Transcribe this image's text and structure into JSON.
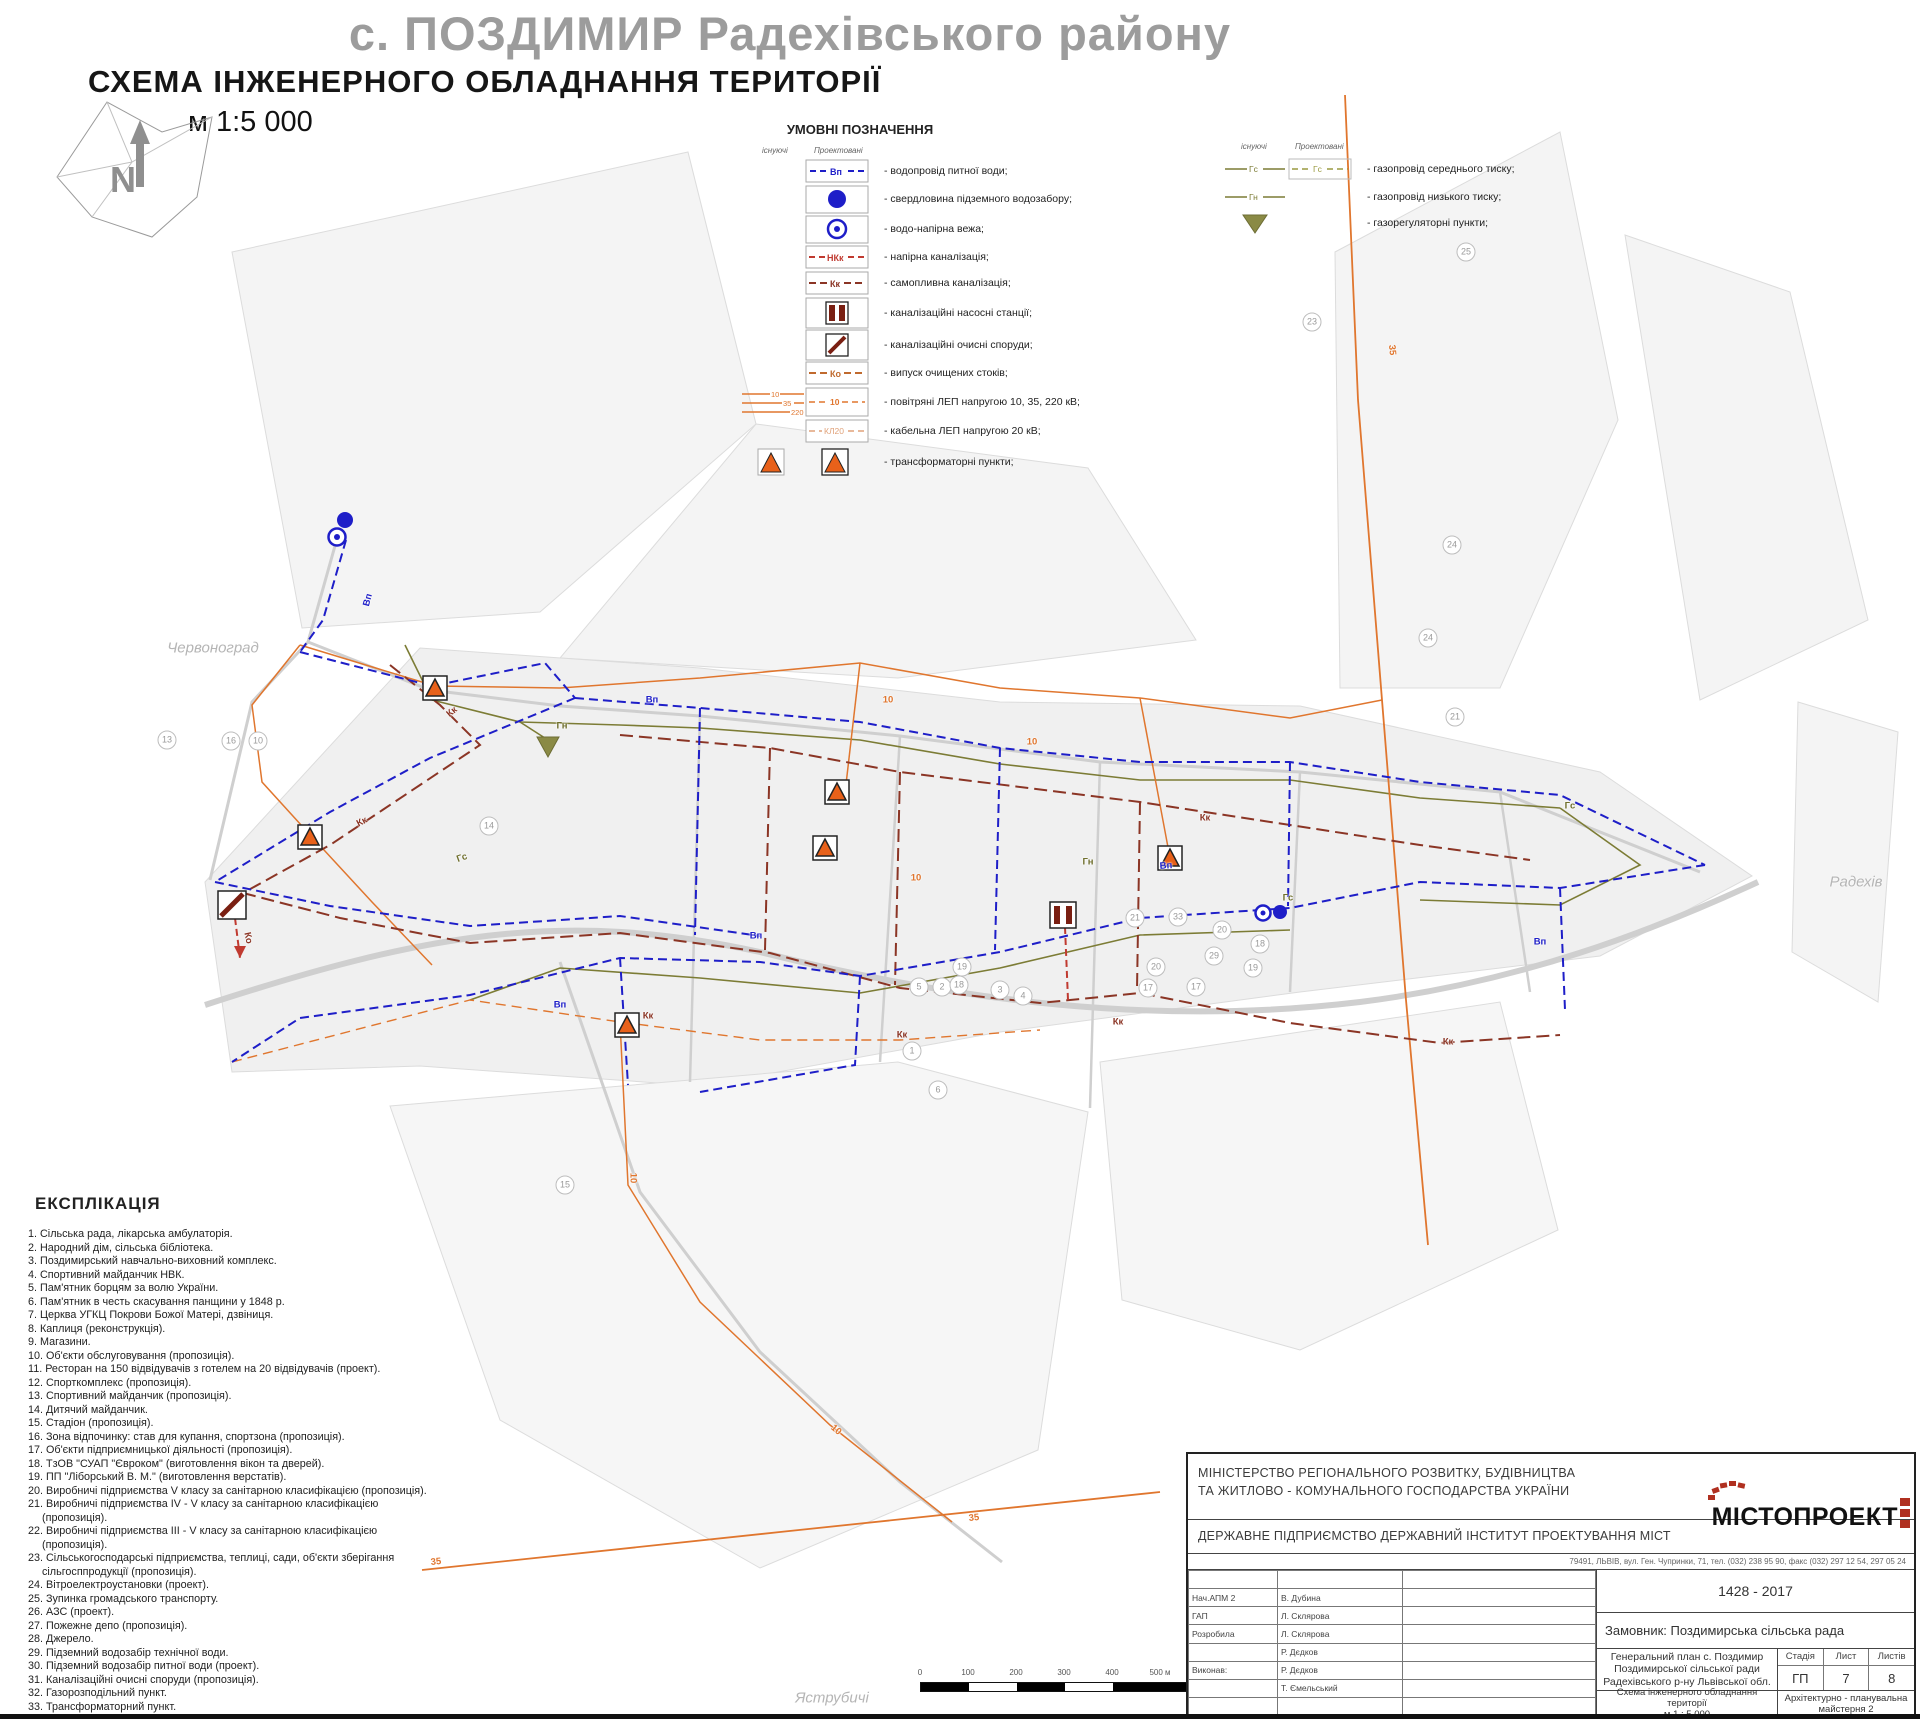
{
  "header": {
    "title": "с. ПОЗДИМИР Радехівського району",
    "subtitle": "СХЕМА ІНЖЕНЕРНОГО ОБЛАДНАННЯ ТЕРИТОРІЇ",
    "scale": "м 1:5 000"
  },
  "legend": {
    "heading": "УМОВНІ ПОЗНАЧЕННЯ",
    "col_existing": "існуючі",
    "col_proposed": "Проектовані",
    "water_items": [
      {
        "code": "Вп",
        "label": "- водопровід питної води;"
      },
      {
        "label": "- свердловина підземного водозабору;"
      },
      {
        "label": "- водо-напірна вежа;"
      },
      {
        "code": "НКк",
        "label": "- напірна каналізація;"
      },
      {
        "code": "Кк",
        "label": "- самопливна каналізація;"
      },
      {
        "label": "- каналізаційні насосні станції;"
      },
      {
        "label": "- каналізаційні очисні споруди;"
      },
      {
        "code": "Ко",
        "label": "- випуск очищених стоків;"
      },
      {
        "codes": [
          "10",
          "35",
          "220"
        ],
        "code": "10",
        "label": "- повітряні ЛЕП напругою 10, 35, 220 кВ;"
      },
      {
        "code": "КЛ20",
        "label": "- кабельна ЛЕП напругою 20 кВ;"
      },
      {
        "label": "- трансформаторні пункти;"
      }
    ],
    "gas_items": [
      {
        "code": "Гс",
        "label": "- газопровід середнього тиску;"
      },
      {
        "code": "Гн",
        "label": "- газопровід низького тиску;"
      },
      {
        "label": "- газорегуляторні пункти;"
      }
    ]
  },
  "explication": {
    "heading": "ЕКСПЛІКАЦІЯ",
    "items": [
      "1. Сільська рада, лікарська амбулаторія.",
      "2. Народний дім, сільська бібліотека.",
      "3. Поздимирський навчально-виховний комплекс.",
      "4. Спортивний майданчик НВК.",
      "5. Пам'ятник борцям за волю України.",
      "6. Пам'ятник в честь скасування панщини у 1848 р.",
      "7. Церква УГКЦ Покрови Божої Матері, дзвіниця.",
      "8. Каплиця (реконструкція).",
      "9. Магазини.",
      "10. Об'єкти обслуговування (пропозиція).",
      "11. Ресторан на 150 відвідувачів з готелем на 20 відвідувачів (проект).",
      "12. Спорткомплекс (пропозиція).",
      "13. Спортивний майданчик (пропозиція).",
      "14. Дитячий майданчик.",
      "15. Стадіон (пропозиція).",
      "16. Зона відпочинку: став для купання, спортзона (пропозиція).",
      "17. Об'єкти підприємницької діяльності (пропозиція).",
      "18. ТзОВ \"СУАП \"Євроком\" (виготовлення вікон та дверей).",
      "19. ПП \"Ліборський В. М.\" (виготовлення верстатів).",
      "20. Виробничі підприємства V класу за санітарною класифікацією (пропозиція).",
      "21. Виробничі підприємства IV - V класу за санітарною класифікацією (пропозиція).",
      "22. Виробничі підприємства III - V класу за санітарною класифікацією (пропозиція).",
      "23. Сільськогосподарські підприємства, теплиці, сади, об'єкти зберігання сільгосппродукції (пропозиція).",
      "24. Вітроелектроустановки (проект).",
      "25. Зупинка громадського транспорту.",
      "26. АЗС (проект).",
      "27. Пожежне депо (пропозиція).",
      "28. Джерело.",
      "29. Підземний водозабір технічної води.",
      "30. Підземний водозабір питної води (проект).",
      "31. Каналізаційні очисні споруди (пропозиція).",
      "32. Газорозподільний пункт.",
      "33. Трансформаторний пункт."
    ]
  },
  "titleblock": {
    "ministry_line1": "МІНІСТЕРСТВО РЕГІОНАЛЬНОГО РОЗВИТКУ, БУДІВНИЦТВА",
    "ministry_line2": "ТА ЖИТЛОВО - КОМУНАЛЬНОГО  ГОСПОДАРСТВА  УКРАЇНИ",
    "institute": "ДЕРЖАВНЕ ПІДПРИЄМСТВО  ДЕРЖАВНИЙ ІНСТИТУТ ПРОЕКТУВАННЯ МІСТ",
    "logo": "МІСТОПРОЕКТ",
    "address": "79491, ЛЬВІВ, вул. Ген. Чупринки, 71, тел. (032) 238 95 90, факс (032) 297 12 54, 297 05 24",
    "project_code": "1428 - 2017",
    "customer": "Замовник: Поздимирська сільська рада",
    "project_title_1": "Генеральний план с. Поздимир",
    "project_title_2": "Поздимирської сільської ради",
    "project_title_3": "Радехівського р-ну Львівської обл.",
    "stage_label": "Стадія",
    "sheet_label": "Лист",
    "sheets_label": "Листів",
    "stage": "ГП",
    "sheet": "7",
    "sheets": "8",
    "doc_title_1": "Схема інженерного обладнання території",
    "doc_title_2": "м 1 : 5 000",
    "workshop": "Архітектурно - планувальна майстерня 2",
    "staff": [
      {
        "role": "",
        "name": ""
      },
      {
        "role": "Нач.АПМ 2",
        "name": "В. Дубина"
      },
      {
        "role": "ГАП",
        "name": "Л. Склярова"
      },
      {
        "role": "Розробила",
        "name": "Л. Склярова"
      },
      {
        "role": "",
        "name": "Р. Дєдков"
      },
      {
        "role": "Виконав:",
        "name": "Р. Дєдков"
      },
      {
        "role": "",
        "name": "Т. Ємельський"
      },
      {
        "role": "",
        "name": ""
      }
    ]
  },
  "scalebar": {
    "ticks": [
      "0",
      "100",
      "200",
      "300",
      "400",
      "500 м"
    ],
    "end_label": "1 км"
  },
  "map": {
    "colors": {
      "water": "#1e1ec8",
      "sewer": "#8b3525",
      "pressure_sewer": "#c03a30",
      "gas": "#7c7c35",
      "power": "#e0762e",
      "transformer_fill": "#e8611a",
      "kns_fill": "#7a1f12"
    },
    "place_labels": [
      {
        "t": "Червоноград",
        "x": 213,
        "y": 648
      },
      {
        "t": "Радехів",
        "x": 1856,
        "y": 882
      },
      {
        "t": "Яструбичі",
        "x": 832,
        "y": 1698
      }
    ],
    "line_labels": [
      {
        "t": "Вп",
        "c": "w",
        "x": 368,
        "y": 600,
        "r": -75
      },
      {
        "t": "Вп",
        "c": "w",
        "x": 652,
        "y": 700,
        "r": 0
      },
      {
        "t": "Вп",
        "c": "w",
        "x": 1166,
        "y": 866,
        "r": -4
      },
      {
        "t": "Вп",
        "c": "w",
        "x": 1540,
        "y": 942,
        "r": 0
      },
      {
        "t": "Вп",
        "c": "w",
        "x": 756,
        "y": 936,
        "r": 0
      },
      {
        "t": "Вп",
        "c": "w",
        "x": 560,
        "y": 1005,
        "r": 0
      },
      {
        "t": "Кк",
        "c": "s",
        "x": 452,
        "y": 712,
        "r": -40
      },
      {
        "t": "Кк",
        "c": "s",
        "x": 362,
        "y": 822,
        "r": -28
      },
      {
        "t": "Кк",
        "c": "s",
        "x": 648,
        "y": 1016,
        "r": 0
      },
      {
        "t": "Кк",
        "c": "s",
        "x": 902,
        "y": 1035,
        "r": 0
      },
      {
        "t": "Кк",
        "c": "s",
        "x": 1118,
        "y": 1022,
        "r": 0
      },
      {
        "t": "Кк",
        "c": "s",
        "x": 1448,
        "y": 1042,
        "r": 0
      },
      {
        "t": "Кк",
        "c": "s",
        "x": 1205,
        "y": 818,
        "r": 0
      },
      {
        "t": "Гс",
        "c": "g",
        "x": 1288,
        "y": 898,
        "r": 0
      },
      {
        "t": "Гс",
        "c": "g",
        "x": 462,
        "y": 858,
        "r": -20
      },
      {
        "t": "Гс",
        "c": "g",
        "x": 1570,
        "y": 806,
        "r": 0
      },
      {
        "t": "Гн",
        "c": "g",
        "x": 1088,
        "y": 862,
        "r": 0
      },
      {
        "t": "Гн",
        "c": "g",
        "x": 562,
        "y": 726,
        "r": 0
      },
      {
        "t": "10",
        "c": "p",
        "x": 888,
        "y": 700,
        "r": 0
      },
      {
        "t": "10",
        "c": "p",
        "x": 1032,
        "y": 742,
        "r": 0
      },
      {
        "t": "10",
        "c": "p",
        "x": 916,
        "y": 878,
        "r": 0
      },
      {
        "t": "10",
        "c": "p",
        "x": 633,
        "y": 1178,
        "r": 90
      },
      {
        "t": "10",
        "c": "p",
        "x": 836,
        "y": 1430,
        "r": 40
      },
      {
        "t": "35",
        "c": "p",
        "x": 436,
        "y": 1562,
        "r": -6
      },
      {
        "t": "35",
        "c": "p",
        "x": 974,
        "y": 1518,
        "r": -6
      },
      {
        "t": "35",
        "c": "p",
        "x": 1392,
        "y": 350,
        "r": 85
      },
      {
        "t": "Ко",
        "c": "s",
        "x": 248,
        "y": 938,
        "r": 78
      }
    ],
    "parcel_numbers": [
      {
        "n": "13",
        "x": 167,
        "y": 740
      },
      {
        "n": "16",
        "x": 231,
        "y": 741
      },
      {
        "n": "10",
        "x": 258,
        "y": 741
      },
      {
        "n": "14",
        "x": 489,
        "y": 826
      },
      {
        "n": "5",
        "x": 919,
        "y": 987
      },
      {
        "n": "2",
        "x": 942,
        "y": 987
      },
      {
        "n": "18",
        "x": 959,
        "y": 985
      },
      {
        "n": "3",
        "x": 1000,
        "y": 990
      },
      {
        "n": "4",
        "x": 1023,
        "y": 996
      },
      {
        "n": "1",
        "x": 912,
        "y": 1051
      },
      {
        "n": "6",
        "x": 938,
        "y": 1090
      },
      {
        "n": "19",
        "x": 962,
        "y": 967
      },
      {
        "n": "21",
        "x": 1135,
        "y": 918
      },
      {
        "n": "33",
        "x": 1178,
        "y": 917
      },
      {
        "n": "20",
        "x": 1222,
        "y": 930
      },
      {
        "n": "18",
        "x": 1260,
        "y": 944
      },
      {
        "n": "29",
        "x": 1214,
        "y": 956
      },
      {
        "n": "20",
        "x": 1156,
        "y": 967
      },
      {
        "n": "19",
        "x": 1253,
        "y": 968
      },
      {
        "n": "17",
        "x": 1196,
        "y": 987
      },
      {
        "n": "17",
        "x": 1148,
        "y": 988
      },
      {
        "n": "24",
        "x": 1428,
        "y": 638
      },
      {
        "n": "24",
        "x": 1452,
        "y": 545
      },
      {
        "n": "21",
        "x": 1455,
        "y": 717
      },
      {
        "n": "23",
        "x": 1312,
        "y": 322
      },
      {
        "n": "25",
        "x": 1466,
        "y": 252
      },
      {
        "n": "15",
        "x": 565,
        "y": 1185
      }
    ]
  }
}
